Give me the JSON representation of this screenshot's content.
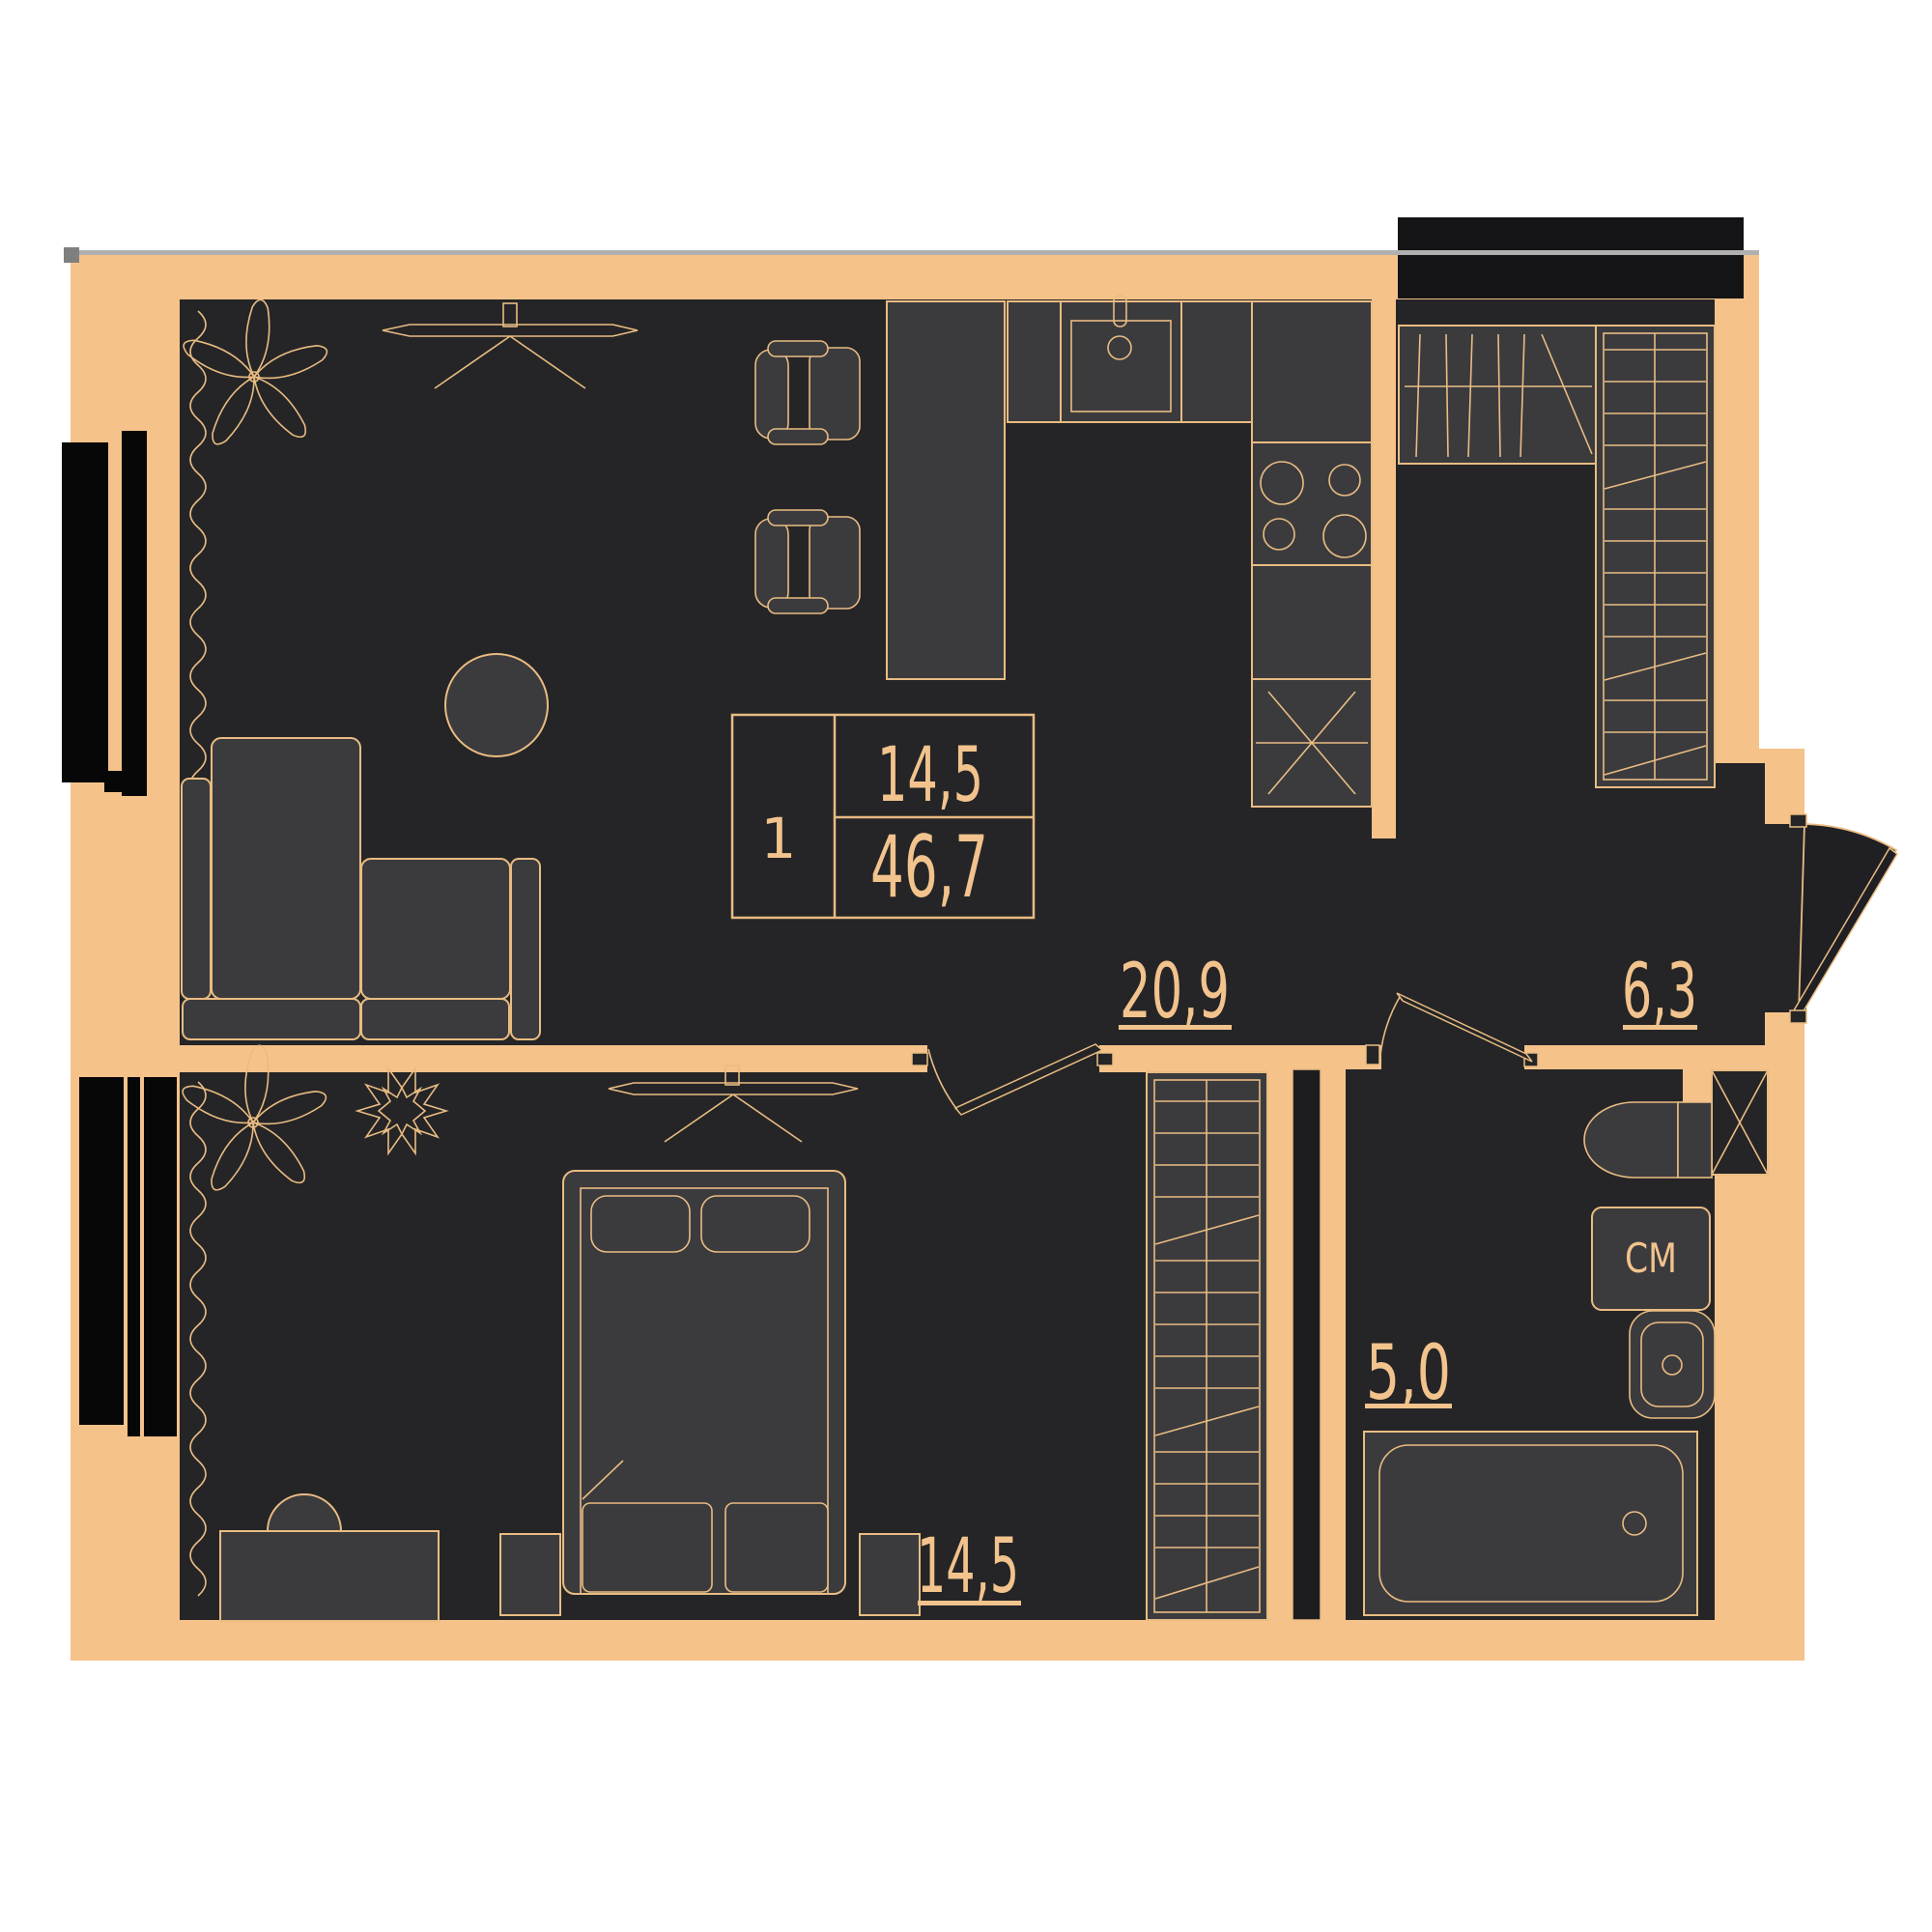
{
  "title": "apartment-floor-plan",
  "palette": {
    "wall": "#F5C28A",
    "floor": "#252527",
    "furniture": "#3B3B3E",
    "outline": "#E9BC82",
    "label_text": "#F2C38D",
    "window_glass": "#070708",
    "shaft": "#141416",
    "page_background": "#FFFFFF",
    "grid_accent_gray": "#ACACAC"
  },
  "info_box": {
    "rooms_count": "1",
    "room_area": "14,5",
    "total_area": "46,7"
  },
  "rooms": {
    "living_kitchen": {
      "name": "living-kitchen",
      "area": "20,9"
    },
    "hallway": {
      "name": "hallway",
      "area": "6,3"
    },
    "bathroom": {
      "name": "bathroom",
      "area": "5,0",
      "washer_label": "СМ"
    },
    "bedroom": {
      "name": "bedroom",
      "area": "14,5"
    }
  },
  "icons": [
    "sofa",
    "coffee-table",
    "dining-chair",
    "kitchen-counter",
    "kitchen-sink",
    "stove-burners",
    "fridge-cross",
    "coat-rack-closet",
    "wardrobe",
    "ceiling-fan",
    "plant",
    "curtain",
    "window",
    "entrance-door",
    "interior-door",
    "toilet",
    "washing-machine",
    "bathroom-sink",
    "bathtub",
    "vent-shaft",
    "bed",
    "nightstand",
    "dresser"
  ]
}
